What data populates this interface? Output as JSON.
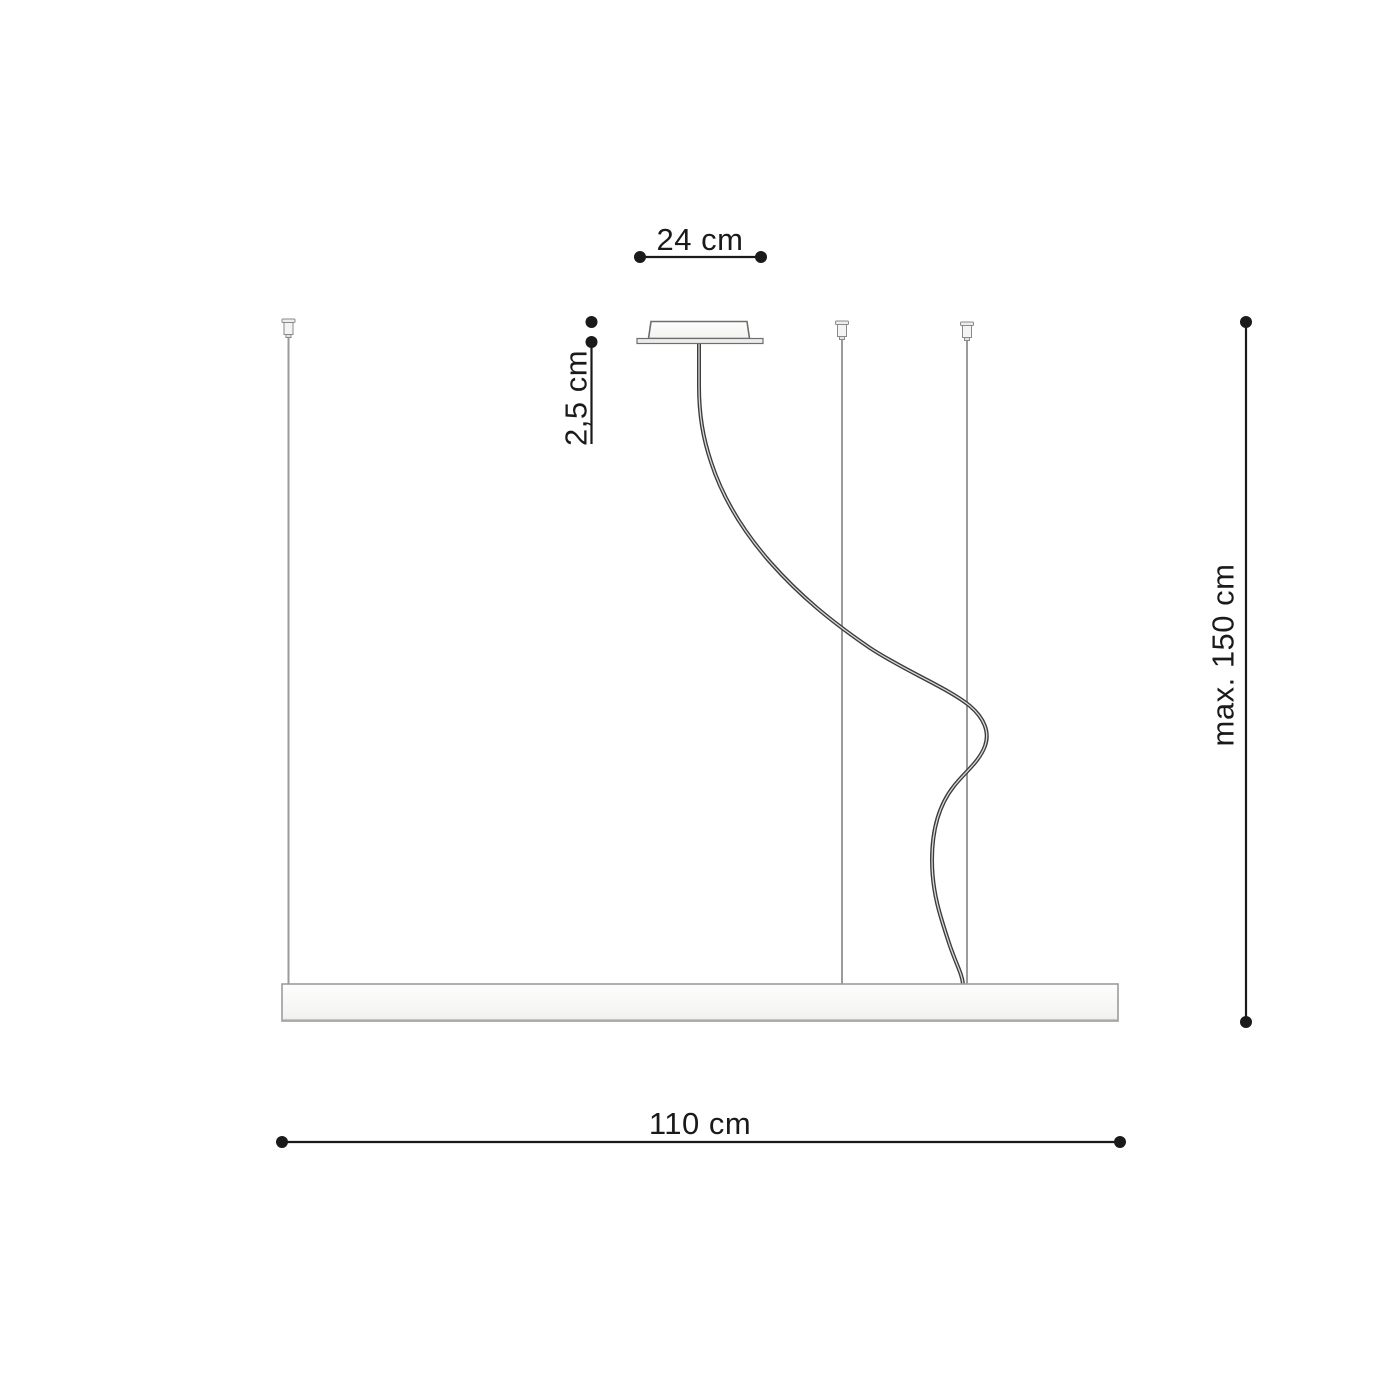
{
  "diagram": {
    "kind": "pendant-lamp-installation-dimension-drawing",
    "dimensions": {
      "canopy_width": "24 cm",
      "canopy_height": "2,5 cm",
      "suspension_max_height": "max. 150 cm",
      "fixture_length": "110 cm"
    },
    "colors": {
      "background": "#ffffff",
      "dimension_ink": "#1a1a1a",
      "suspension_wire": "#9b9b9b",
      "power_cable": "#3c3c3c",
      "fixture_fill": "#f6f6f5",
      "fixture_border": "#9c9c9c",
      "canopy_border": "#6e6e6e"
    }
  }
}
